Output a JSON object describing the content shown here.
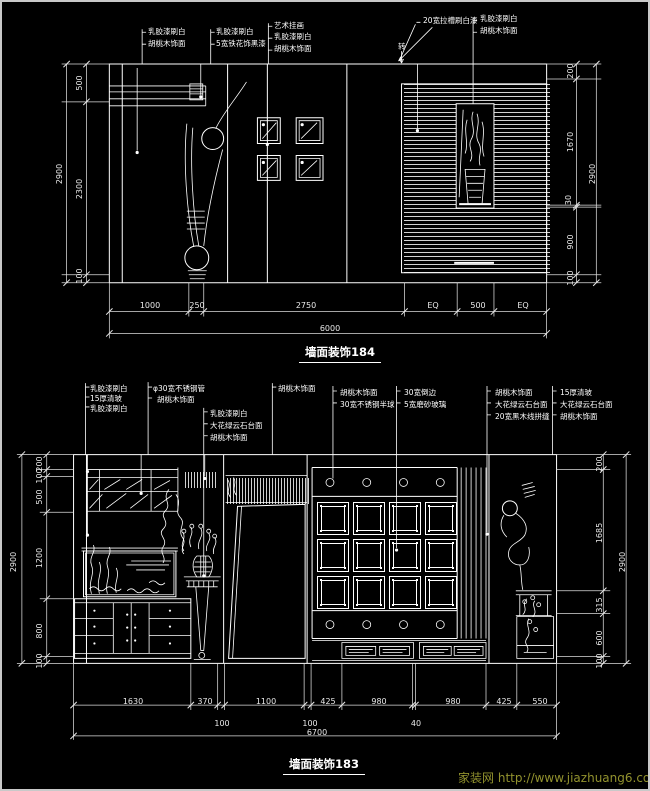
{
  "page": {
    "background": "#000000",
    "line_color": "#ffffff",
    "watermark_color": "#92922e"
  },
  "top_drawing": {
    "title": "墙面装饰184",
    "labels": {
      "a1": "乳胶漆刷白",
      "a2": "胡桃木饰面",
      "b1": "乳胶漆刷白",
      "b2": "5宽铁花饰黑漆",
      "c1": "艺术挂画",
      "c2": "乳胶漆刷白",
      "c3": "胡桃木饰面",
      "d1": "20宽拉槽刷白漆",
      "e1": "乳胶漆刷白",
      "e2": "胡桃木饰面",
      "rotate_note": "转"
    },
    "dims": {
      "left": [
        "500",
        "2300",
        "100"
      ],
      "left_total": "2900",
      "right": [
        "200",
        "1670",
        "30",
        "900",
        "100"
      ],
      "right_total": "2900",
      "bottom": [
        "1000",
        "250",
        "2750",
        "EQ",
        "500",
        "EQ"
      ],
      "bottom_total": "6000"
    }
  },
  "bottom_drawing": {
    "title": "墙面装饰183",
    "labels": {
      "g1a": "乳胶漆刷白",
      "g1b": "15厚清玻",
      "g1c": "乳胶漆刷白",
      "g2a": "φ30宽不锈钢管",
      "g2b": "胡桃木饰面",
      "g3a": "乳胶漆刷白",
      "g3b": "大花绿云石台面",
      "g3c": "胡桃木饰面",
      "g4a": "胡桃木饰面",
      "g5a": "胡桃木饰面",
      "g5b": "30宽不锈钢半球",
      "g6a": "30宽倒边",
      "g6b": "5宽磨砂玻璃",
      "g7a": "胡桃木饰面",
      "g7b": "大花绿云石台面",
      "g7c": "20宽黑木线拼缝",
      "g8a": "15厚清玻",
      "g8b": "大花绿云石台面",
      "g8c": "胡桃木饰面"
    },
    "dims": {
      "left": [
        "200",
        "100",
        "500",
        "1200",
        "800",
        "100"
      ],
      "left_total": "2900",
      "right": [
        "200",
        "1685",
        "315",
        "600",
        "100"
      ],
      "right_total": "2900",
      "bottom": [
        "1630",
        "370",
        "1100",
        "425",
        "980",
        "980",
        "425",
        "550"
      ],
      "bottom_sub": [
        "100",
        "100",
        "40"
      ],
      "bottom_total": "6700"
    }
  },
  "watermark": {
    "site_name": "家装网",
    "url": "http://www.jiazhuang6.com"
  }
}
